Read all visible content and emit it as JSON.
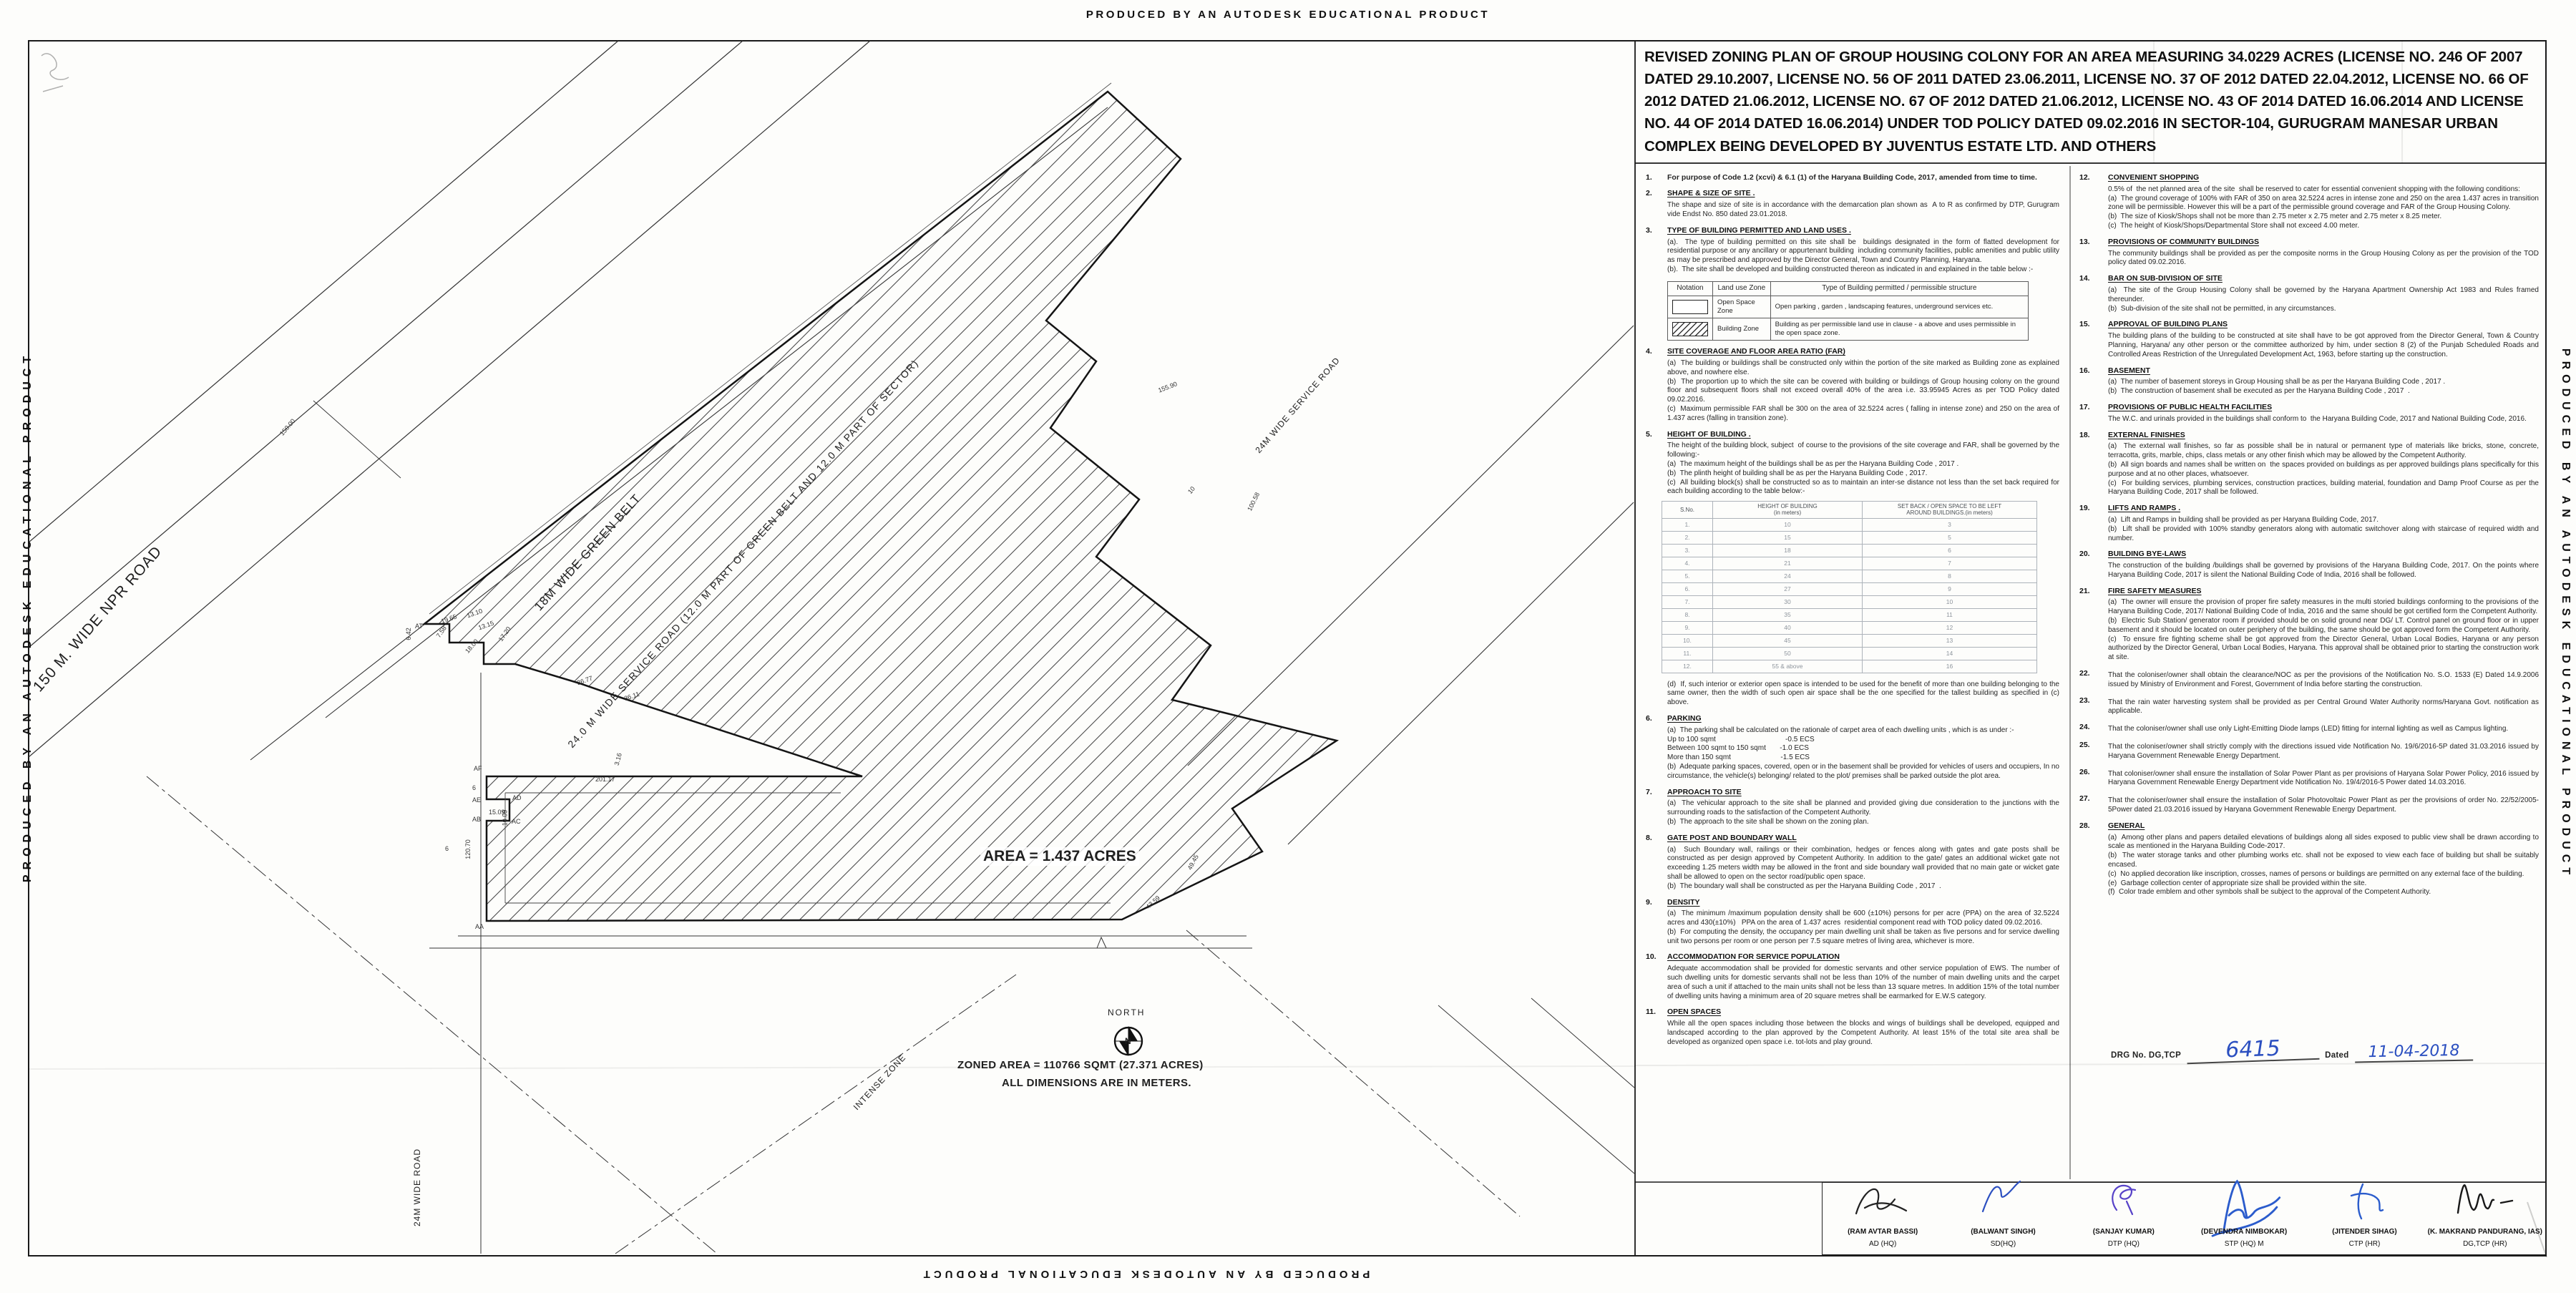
{
  "banner": {
    "text": "PRODUCED BY AN AUTODESK EDUCATIONAL PRODUCT"
  },
  "title_block": {
    "title": "REVISED ZONING PLAN OF GROUP HOUSING COLONY FOR AN AREA MEASURING 34.0229 ACRES (LICENSE NO. 246 OF 2007 DATED 29.10.2007, LICENSE NO. 56 OF 2011 DATED 23.06.2011, LICENSE NO. 37 OF 2012 DATED 22.04.2012, LICENSE NO. 66 OF 2012 DATED 21.06.2012, LICENSE NO. 67 OF 2012 DATED 21.06.2012, LICENSE NO. 43 OF 2014 DATED 16.06.2014 AND LICENSE NO. 44 OF 2014 DATED 16.06.2014) UNDER TOD POLICY DATED 09.02.2016 IN SECTOR-104, GURUGRAM MANESAR URBAN COMPLEX BEING DEVELOPED BY JUVENTUS ESTATE LTD. AND OTHERS"
  },
  "plan": {
    "north_label": "NORTH",
    "compass_n": "N",
    "area_label": "AREA = 1.437 ACRES",
    "zoned_area_line1": "ZONED  AREA = 110766 SQMT (27.371 ACRES)",
    "zoned_area_line2": "ALL DIMENSIONS ARE IN METERS.",
    "zone_label": "INTENSE ZONE",
    "roads": {
      "npr": "150 M. WIDE NPR ROAD",
      "green_belt": "18M WIDE GREEN BELT",
      "service_road_long": "24.0 M  WIDE  SERVICE  ROAD (12.0 M PART OF GREEN BELT AND 12.0 M PART OF  SECTOR)",
      "service_road": "24M WIDE SERVICE ROAD",
      "left_road": "24M WIDE ROAD"
    },
    "dims": [
      "150.00",
      "18.00",
      "155.90",
      "100.58",
      "201.17",
      "120.70",
      "43.59",
      "49.45",
      "15.09",
      "10.09",
      "36.77",
      "36.11",
      "19.65",
      "13.10",
      "13.15",
      "17.20",
      "7.58",
      "6.42",
      "3.16",
      "10",
      "6",
      "6"
    ],
    "points": [
      "AT",
      "AF",
      "AE",
      "AB",
      "AD",
      "AC",
      "AA"
    ]
  },
  "clauses_left": [
    {
      "no": "1.",
      "heading": "",
      "body": "For purpose of Code 1.2 (xcvi) & 6.1 (1) of the Haryana Building Code, 2017, amended from time to time."
    },
    {
      "no": "2.",
      "heading": "SHAPE & SIZE OF SITE .",
      "body": "The shape and size of site is in accordance with the demarcation plan shown as  A to R as confirmed by DTP, Gurugram vide Endst No. 850 dated 23.01.2018."
    },
    {
      "no": "3.",
      "heading": "TYPE OF BUILDING PERMITTED AND LAND USES .",
      "body": "(a).  The type of building permitted on this site shall be  buildings designated in the form of flatted development for residential purpose or any ancillary or appurtenant building  including community facilities, public amenities and public utility as may be prescribed and approved by the Director General, Town and Country Planning, Haryana.\n(b).  The site shall be developed and building constructed thereon as indicated in and explained in the table below :-"
    },
    {
      "no": "4.",
      "heading": "SITE COVERAGE AND FLOOR AREA RATIO (FAR)",
      "body": "(a)  The building or buildings shall be constructed only within the portion of the site marked as Building zone as explained above, and nowhere else.\n(b)  The proportion up to which the site can be covered with building or buildings of Group housing colony on the ground floor and subsequent floors shall not exceed overall 40% of the area i.e. 33.95945 Acres as per TOD Policy dated 09.02.2016.\n(c)  Maximum permissible FAR shall be 300 on the area of 32.5224 acres ( falling in intense zone) and 250 on the area of 1.437 acres (falling in transition zone)."
    },
    {
      "no": "5.",
      "heading": "HEIGHT OF BUILDING .",
      "body": "The height of the building block, subject  of course to the provisions of the site coverage and FAR, shall be governed by the following:-\n(a)  The maximum height of the buildings shall be as per the Haryana Building Code , 2017 .\n(b)  The plinth height of building shall be as per the Haryana Building Code , 2017.\n(c)  All building block(s) shall be constructed so as to maintain an inter-se distance not less than the set back required for each building according to the table below:-"
    },
    {
      "no": "6.",
      "heading": "PARKING",
      "body": "(a)  The parking shall be calculated on the rationale of carpet area of each dwelling units , which is as under :-\nUp to 100 sqmt                                   -0.5 ECS\nBetween 100 sqmt to 150 sqmt       -1.0 ECS\nMore than 150 sqmt                         -1.5 ECS\n(b)  Adequate parking spaces, covered, open or in the basement shall be provided for vehicles of users and occupiers, In no circumstance, the vehicle(s) belonging/ related to the plot/ premises shall be parked outside the plot area."
    },
    {
      "no": "7.",
      "heading": "APPROACH TO SITE",
      "body": "(a)  The vehicular approach to the site shall be planned and provided giving due consideration to the junctions with the surrounding roads to the satisfaction of the Competent Authority.\n(b)  The approach to the site shall be shown on the zoning plan."
    },
    {
      "no": "8.",
      "heading": "GATE POST AND BOUNDARY WALL",
      "body": "(a)  Such Boundary wall, railings or their combination, hedges or fences along with gates and gate posts shall be constructed as per design approved by Competent Authority. In addition to the gate/ gates an additional wicket gate not exceeding 1.25 meters width may be allowed in the front and side boundary wall provided that no main gate or wicket gate shall be allowed to open on the sector road/public open space.\n(b)  The boundary wall shall be constructed as per the Haryana Building Code , 2017  ."
    },
    {
      "no": "9.",
      "heading": "DENSITY",
      "body": "(a)  The minimum /maximum population density shall be 600 (±10%) persons for per acre (PPA) on the area of 32.5224 acres and 430(±10%)   PPA on the area of 1.437 acres  residential component read with TOD policy dated 09.02.2016.\n(b)  For computing the density, the occupancy per main dwelling unit shall be taken as five persons and for service dwelling unit two persons per room or one person per 7.5 square metres of living area, whichever is more."
    },
    {
      "no": "10.",
      "heading": "ACCOMMODATION FOR SERVICE POPULATION",
      "body": "Adequate accommodation shall be provided for domestic servants and other service population of EWS. The number of such dwelling units for domestic servants shall not be less than 10% of the number of main dwelling units and the carpet area of such a unit if attached to the main units shall not be less than 13 square metres. In addition 15% of the total number of dwelling units having a minimum area of 20 square metres shall be earmarked for E.W.S category."
    },
    {
      "no": "11.",
      "heading": "OPEN SPACES",
      "body": "While all the open spaces including those between the blocks and wings of buildings shall be developed, equipped and landscaped according to the plan approved by the Competent Authority. At least 15% of the total site area shall be developed as organized open space i.e. tot-lots and play ground."
    }
  ],
  "clause5_d": "(d)  If, such interior or exterior open space is intended to be used for the benefit of more than one building belonging to the same owner, then the width of such open air space shall be the one specified for the tallest building as specified in (c) above.",
  "notation_table": {
    "headers": [
      "Notation",
      "Land use Zone",
      "Type of Building permitted / permissible structure"
    ],
    "rows": [
      {
        "zone": "Open Space Zone",
        "type": "Open parking , garden , landscaping features, underground services etc."
      },
      {
        "zone": "Building Zone",
        "type": "Building as per permissible land use in clause - a above and uses permissible in the open space zone."
      }
    ]
  },
  "height_table": {
    "headers": [
      "S.No.",
      "HEIGHT OF BUILDING\n(in meters)",
      "SET BACK / OPEN SPACE TO BE LEFT\nAROUND BUILDINGS.(in meters)"
    ],
    "rows": [
      [
        "1.",
        "10",
        "3"
      ],
      [
        "2.",
        "15",
        "5"
      ],
      [
        "3.",
        "18",
        "6"
      ],
      [
        "4.",
        "21",
        "7"
      ],
      [
        "5.",
        "24",
        "8"
      ],
      [
        "6.",
        "27",
        "9"
      ],
      [
        "7.",
        "30",
        "10"
      ],
      [
        "8.",
        "35",
        "11"
      ],
      [
        "9.",
        "40",
        "12"
      ],
      [
        "10.",
        "45",
        "13"
      ],
      [
        "11.",
        "50",
        "14"
      ],
      [
        "12.",
        "55 & above",
        "16"
      ]
    ]
  },
  "clauses_right": [
    {
      "no": "12.",
      "heading": "CONVENIENT SHOPPING",
      "body": "0.5% of  the net planned area of the site  shall be reserved to cater for essential convenient shopping with the following conditions:\n(a)  The ground coverage of 100% with FAR of 350 on area 32.5224 acres in intense zone and 250 on the area 1.437 acres in transition zone will be permissible. However this will be a part of the permissible ground coverage and FAR of the Group Housing Colony.\n(b)  The size of Kiosk/Shops shall not be more than 2.75 meter x 2.75 meter and 2.75 meter x 8.25 meter.\n(c)  The height of Kiosk/Shops/Departmental Store shall not exceed 4.00 meter."
    },
    {
      "no": "13.",
      "heading": "PROVISIONS OF COMMUNITY BUILDINGS",
      "body": "The community buildings shall be provided as per the composite norms in the Group Housing Colony as per the provision of the TOD policy dated 09.02.2016."
    },
    {
      "no": "14.",
      "heading": "BAR ON SUB-DIVISION OF SITE",
      "body": "(a)  The site of the Group Housing Colony shall be governed by the Haryana Apartment Ownership Act 1983 and Rules framed thereunder.\n(b)  Sub-division of the site shall not be permitted, in any circumstances."
    },
    {
      "no": "15.",
      "heading": "APPROVAL OF BUILDING PLANS",
      "body": "The building plans of the building to be constructed at site shall have to be got approved from the Director General, Town & Country Planning, Haryana/ any other person or the committee authorized by him, under section 8 (2) of the Punjab Scheduled Roads and Controlled Areas Restriction of the Unregulated Development Act, 1963, before starting up the construction."
    },
    {
      "no": "16.",
      "heading": "BASEMENT",
      "body": "(a)  The number of basement storeys in Group Housing shall be as per the Haryana Building Code , 2017 .\n(b)  The construction of basement shall be executed as per the Haryana Building Code , 2017  ."
    },
    {
      "no": "17.",
      "heading": "PROVISIONS OF PUBLIC HEALTH FACILITIES",
      "body": "The W.C. and urinals provided in the buildings shall conform to  the Haryana Building Code, 2017 and National Building Code, 2016."
    },
    {
      "no": "18.",
      "heading": "EXTERNAL FINISHES",
      "body": "(a)  The external wall finishes, so far as possible shall be in natural or permanent type of materials like bricks, stone, concrete, terracotta, grits, marble, chips, class metals or any other finish which may be allowed by the Competent Authority.\n(b)  All sign boards and names shall be written on  the spaces provided on buildings as per approved buildings plans specifically for this purpose and at no other places, whatsoever.\n(c)  For building services, plumbing services, construction practices, building material, foundation and Damp Proof Course as per the Haryana Building Code, 2017 shall be followed."
    },
    {
      "no": "19.",
      "heading": "LIFTS AND RAMPS .",
      "body": "(a)  Lift and Ramps in building shall be provided as per Haryana Building Code, 2017.\n(b)  Lift shall be provided with 100% standby generators along with automatic switchover along with staircase of required width and number."
    },
    {
      "no": "20.",
      "heading": "BUILDING BYE-LAWS",
      "body": "The construction of the building /buildings shall be governed by provisions of the Haryana Building Code, 2017. On the points where Haryana Building Code, 2017 is silent the National Building Code of India, 2016 shall be followed."
    },
    {
      "no": "21.",
      "heading": "FIRE SAFETY MEASURES",
      "body": "(a)  The owner will ensure the provision of proper fire safety measures in the multi storied buildings conforming to the provisions of the Haryana Building Code, 2017/ National Building Code of India, 2016 and the same should be got certified form the Competent Authority.\n(b)  Electric Sub Station/ generator room if provided should be on solid ground near DG/ LT. Control panel on ground floor or in upper basement and it should be located on outer periphery of the building, the same should be got approved form the Competent Authority.\n(c)  To ensure fire fighting scheme shall be got approved from the Director General, Urban Local Bodies, Haryana or any person authorized by the Director General, Urban Local Bodies, Haryana. This approval shall be obtained prior to starting the construction work at site."
    },
    {
      "no": "22.",
      "heading": "",
      "body": "That the coloniser/owner shall obtain the clearance/NOC as per the provisions of the Notification No. S.O. 1533 (E) Dated 14.9.2006  issued by Ministry of Environment and Forest, Government of India before starting the construction."
    },
    {
      "no": "23.",
      "heading": "",
      "body": "That the rain water harvesting system shall be provided as per Central Ground Water Authority norms/Haryana Govt. notification as applicable."
    },
    {
      "no": "24.",
      "heading": "",
      "body": "That the coloniser/owner shall use only Light-Emitting Diode lamps (LED) fitting for internal lighting as well as Campus lighting."
    },
    {
      "no": "25.",
      "heading": "",
      "body": "That the coloniser/owner shall strictly comply with the directions issued vide Notification No. 19/6/2016-5P dated 31.03.2016 issued by Haryana Government Renewable Energy Department."
    },
    {
      "no": "26.",
      "heading": "",
      "body": "That coloniser/owner shall ensure the installation of Solar Power Plant as per provisions of Haryana Solar Power Policy, 2016 issued by Haryana Government Renewable Energy Department vide Notification No. 19/4/2016-5 Power dated 14.03.2016."
    },
    {
      "no": "27.",
      "heading": "",
      "body": "That the coloniser/owner shall ensure the installation of Solar Photovoltaic Power Plant as per the provisions of order No. 22/52/2005-5Power dated 21.03.2016 issued by Haryana Government Renewable Energy Department."
    },
    {
      "no": "28.",
      "heading": "GENERAL",
      "body": "(a)  Among other plans and papers detailed elevations of buildings along all sides exposed to public view shall be drawn according to scale as mentioned in the Haryana Building Code-2017.\n(b)  The water storage tanks and other plumbing works etc. shall not be exposed to view each face of building but shall be suitably encased.\n(c)  No applied decoration like inscription, crosses, names of persons or buildings are permitted on any external face of the building.\n(e)  Garbage collection center of appropriate size shall be provided within the site.\n(f)  Color trade emblem and other symbols shall be subject to the approval of the Competent Authority."
    }
  ],
  "drg": {
    "label": "DRG No. DG,TCP",
    "number": "6415",
    "dated_label": "Dated",
    "date": "11-04-2018"
  },
  "signatures": [
    {
      "name": "(RAM AVTAR BASSI)",
      "title": "AD (HQ)"
    },
    {
      "name": "(BALWANT SINGH)",
      "title": "SD(HQ)"
    },
    {
      "name": "(SANJAY KUMAR)",
      "title": "DTP (HQ)"
    },
    {
      "name": "(DEVENDRA NIMBOKAR)",
      "title": "STP (HQ) M"
    },
    {
      "name": "(JITENDER SIHAG)",
      "title": "CTP (HR)"
    },
    {
      "name": "(K. MAKRAND PANDURANG, IAS)",
      "title": "DG,TCP (HR)"
    }
  ]
}
